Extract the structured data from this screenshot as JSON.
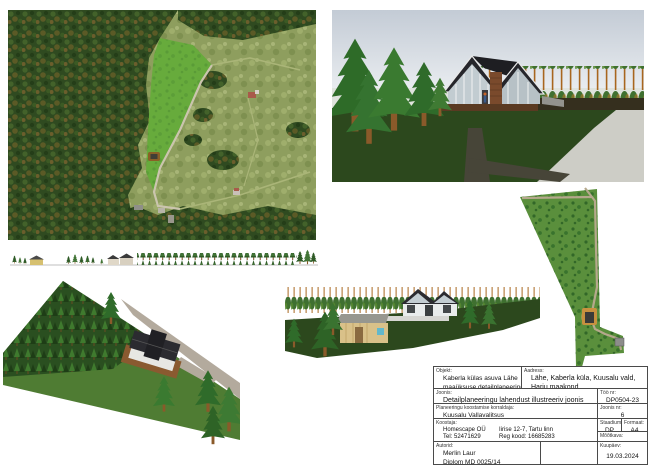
{
  "titleblock": {
    "object_label": "Objekt:",
    "object_line1": "Kaberla külas asuva Lähe",
    "object_line2": "maaüksuse detailplaneering",
    "address_label": "Aadress:",
    "address_line1": "Lähe, Kaberla küla, Kuusalu vald,",
    "address_line2": "Harju maakond",
    "drawing_label": "Joonis:",
    "drawing_value": "Detailplaneeringu lahendust illustreeriv joonis",
    "organizer_label": "Planeeringu koostamise korraldaja:",
    "organizer_value": "Kuusalu Vallavalitsus",
    "compiler_label": "Koostaja:",
    "compiler_name": "Homescape OÜ",
    "compiler_address": "Iirise 12-7, Tartu linn",
    "compiler_tel": "Tel: 52471629",
    "compiler_reg": "Reg kood: 16685283",
    "author_label": "Autorid:",
    "author_line1": "Merlin Laur",
    "author_line2": "Diplom MD 0025/14",
    "work_no_label": "Töö nr:",
    "work_no_value": "DP0504-23",
    "sheet_no_label": "Joonis nr:",
    "sheet_no_value": "6",
    "stage_label": "Staadium:",
    "stage_value": "DP",
    "format_label": "Formaat:",
    "format_value": "A4",
    "scale_label": "Mõõtkava:",
    "scale_value": "",
    "date_label": "Kuupäev:",
    "date_value": "19.03.2024"
  },
  "colors": {
    "clearing_green": "#67ab3c",
    "forest_dark": "#2f4a20",
    "lawn_green": "#2c481d",
    "roof_dark": "#26262b",
    "road_gray": "#cdcdc6",
    "path_tan": "#b5a88c",
    "sky_top": "#c3cbd5",
    "wood_tan": "#d9c189",
    "site_green": "#5a8f3c"
  }
}
